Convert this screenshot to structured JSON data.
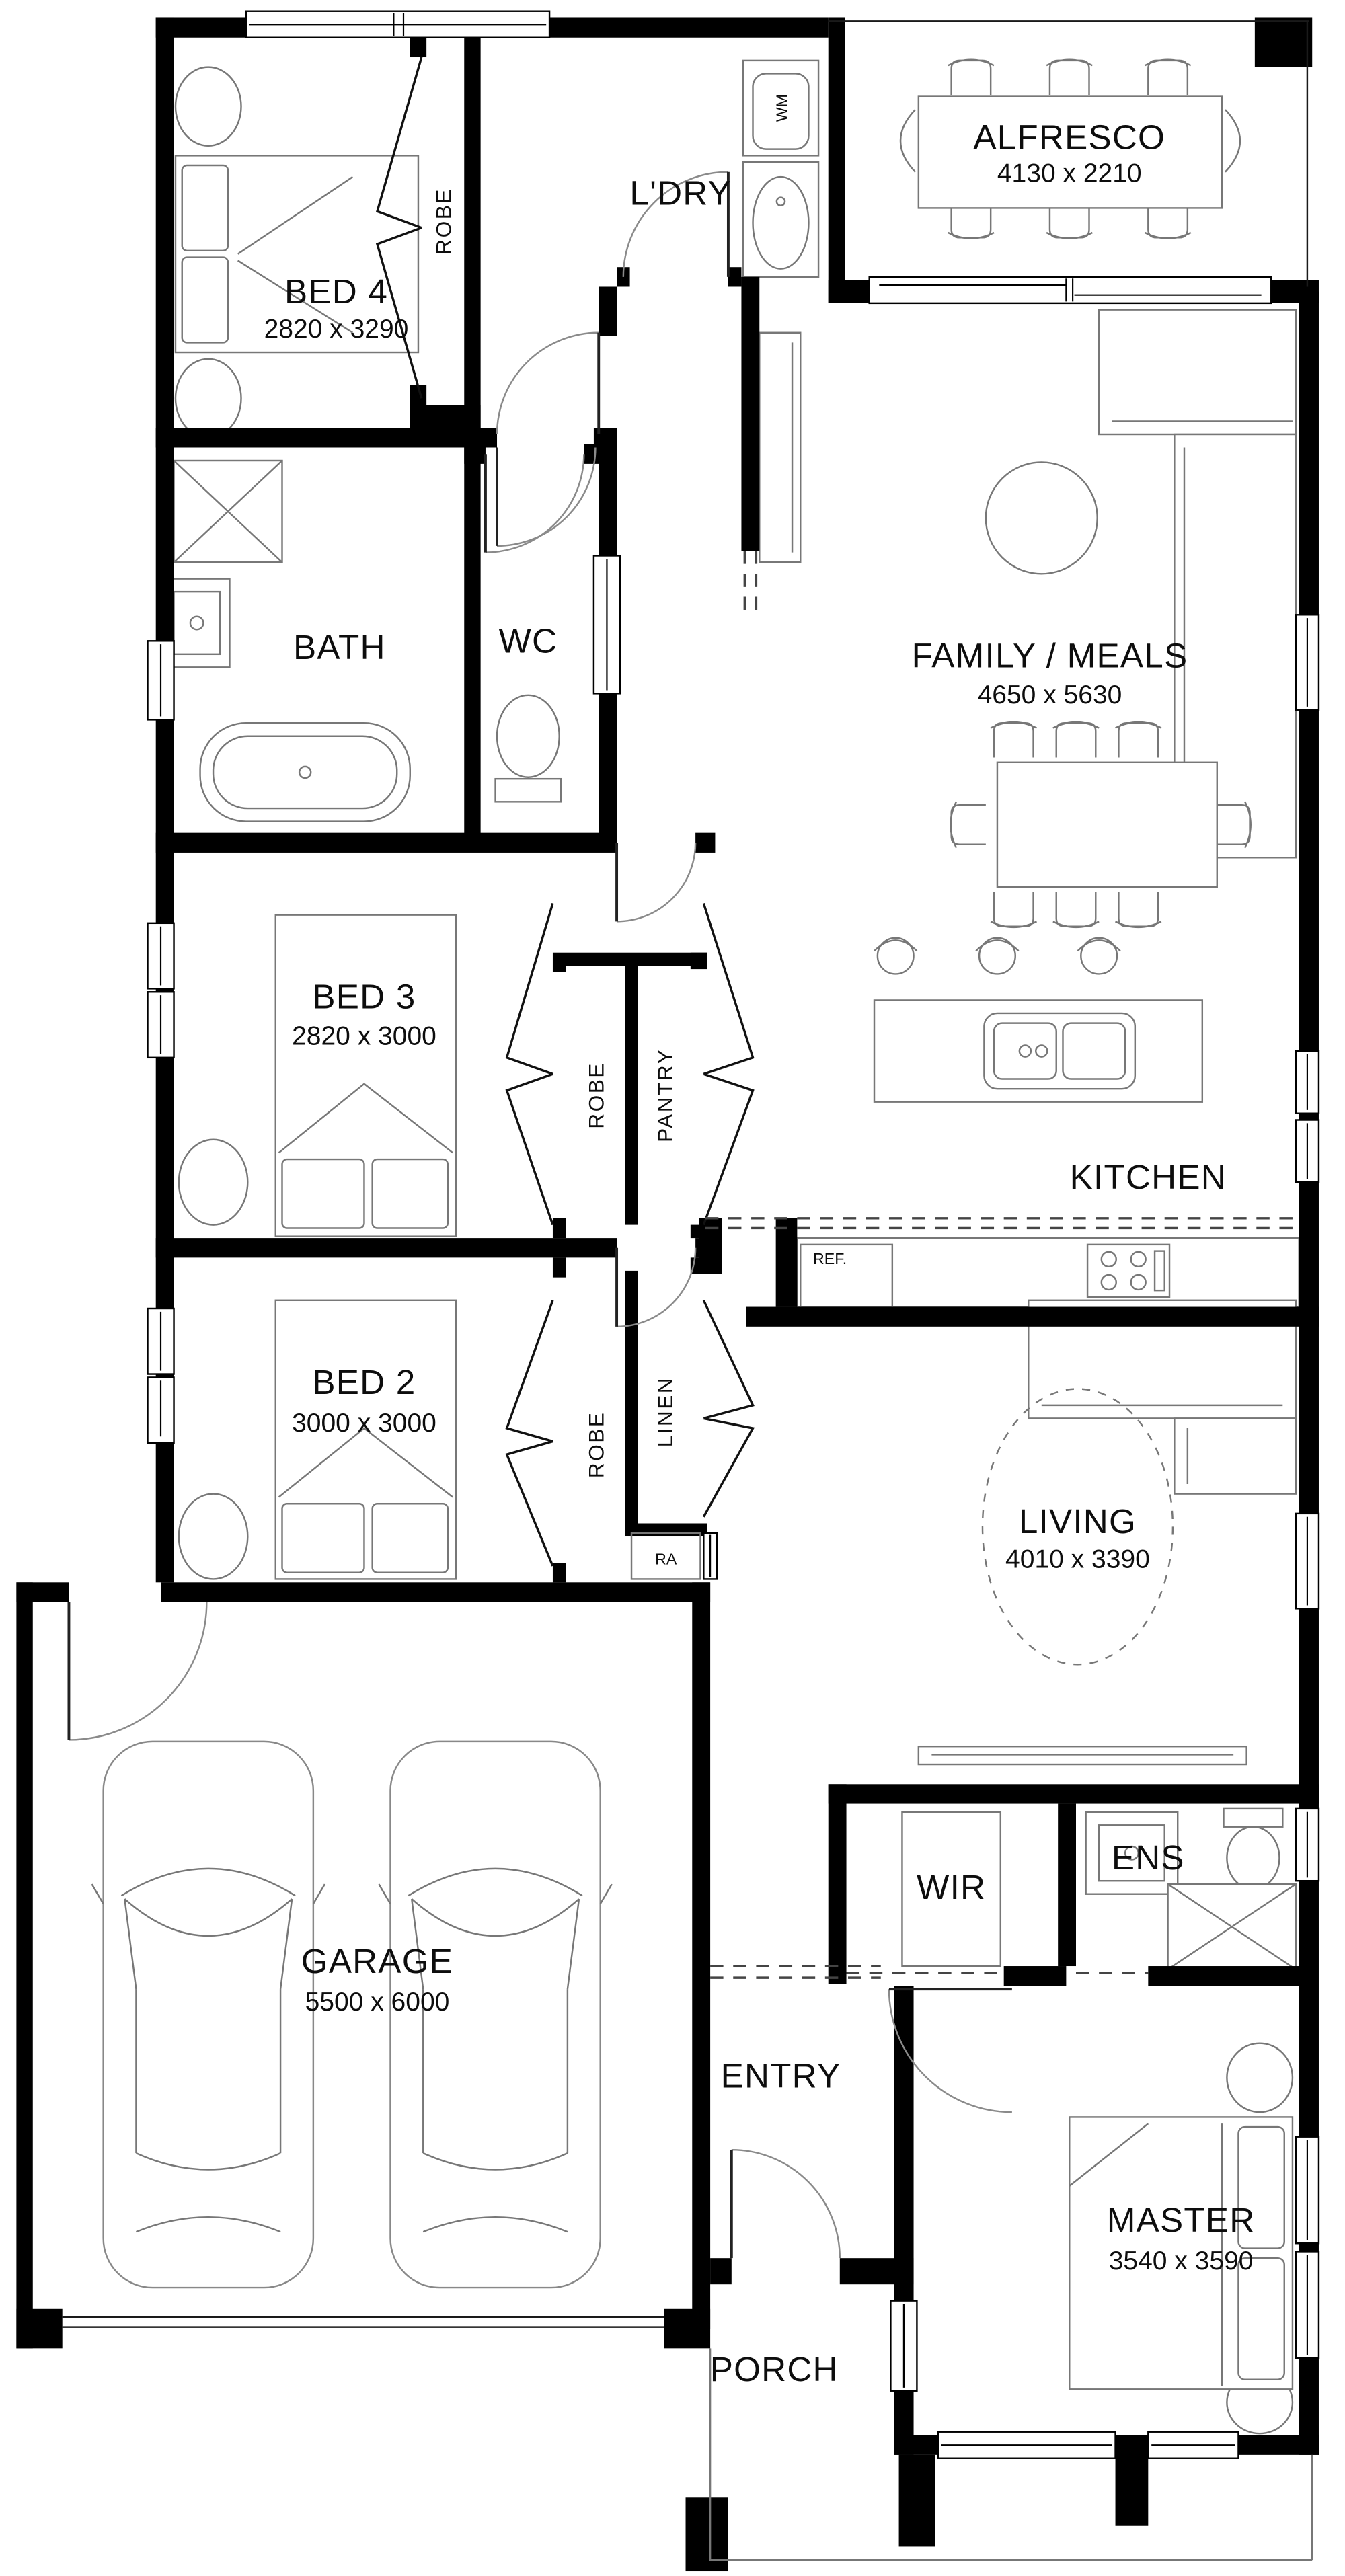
{
  "plan_title": "Single storey house floor plan",
  "labels": {
    "bed4": {
      "name": "BED 4",
      "dims": "2820 x 3290"
    },
    "bed3": {
      "name": "BED 3",
      "dims": "2820 x 3000"
    },
    "bed2": {
      "name": "BED 2",
      "dims": "3000 x 3000"
    },
    "master": {
      "name": "MASTER",
      "dims": "3540 x 3590"
    },
    "family": {
      "name": "FAMILY / MEALS",
      "dims": "4650 x 5630"
    },
    "living": {
      "name": "LIVING",
      "dims": "4010 x 3390"
    },
    "alfresco": {
      "name": "ALFRESCO",
      "dims": "4130 x 2210"
    },
    "garage": {
      "name": "GARAGE",
      "dims": "5500 x 6000"
    },
    "kitchen": "KITCHEN",
    "bath": "BATH",
    "wc": "WC",
    "ldry": "L'DRY",
    "entry": "ENTRY",
    "porch": "PORCH",
    "wir": "WIR",
    "ens": "ENS",
    "robe": "ROBE",
    "pantry": "PANTRY",
    "linen": "LINEN",
    "ra": "RA",
    "ref": "REF.",
    "wm": "WM"
  }
}
